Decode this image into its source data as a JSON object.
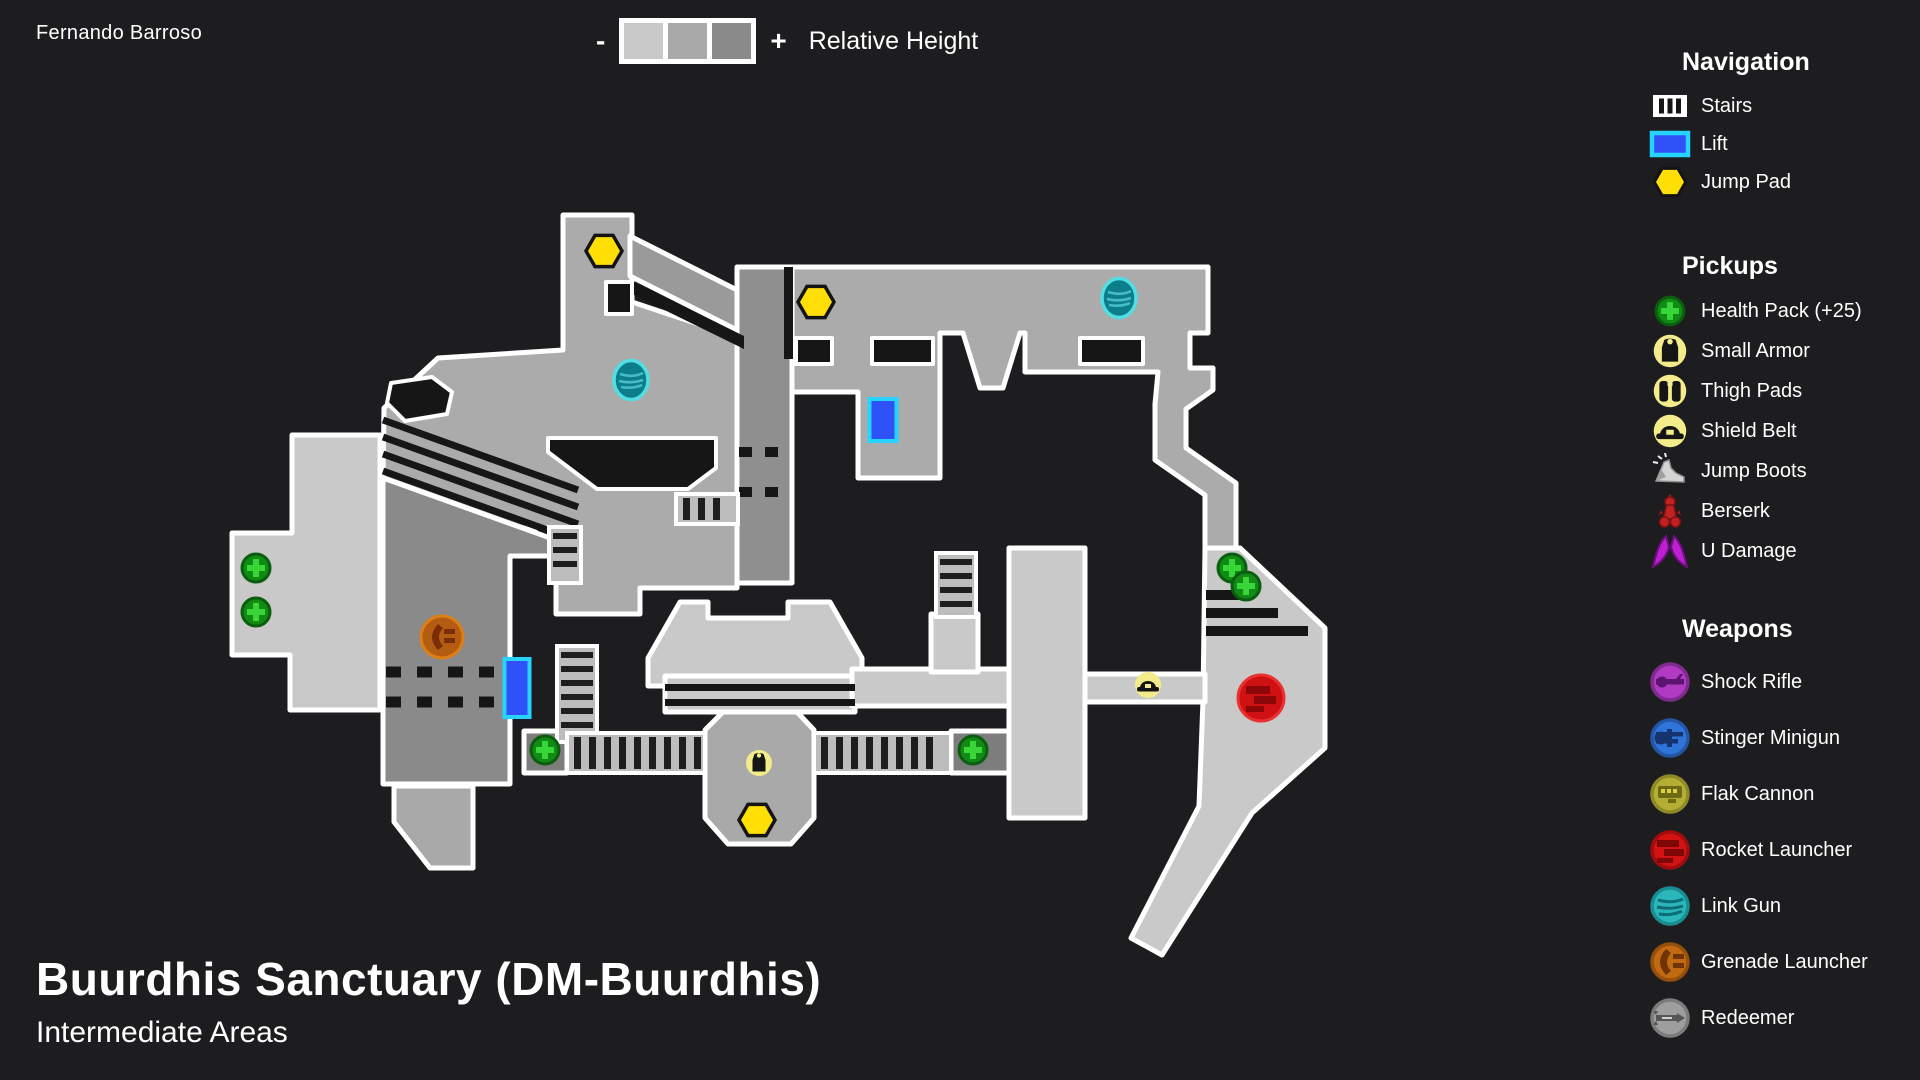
{
  "page": {
    "author": "Fernando Barroso",
    "title": "Buurdhis Sanctuary (DM-Buurdhis)",
    "subtitle": "Intermediate Areas"
  },
  "height_legend": {
    "minus": "-",
    "plus": "+",
    "label": "Relative Height",
    "swatches": [
      "#c9c9c9",
      "#a9a9a9",
      "#8a8a8a"
    ]
  },
  "sidebar": {
    "navigation": {
      "title": "Navigation",
      "items": [
        {
          "icon": "stairs",
          "label": "Stairs"
        },
        {
          "icon": "lift",
          "label": "Lift"
        },
        {
          "icon": "jump-pad",
          "label": "Jump Pad"
        }
      ]
    },
    "pickups": {
      "title": "Pickups",
      "items": [
        {
          "icon": "health-pack",
          "label": "Health Pack (+25)"
        },
        {
          "icon": "small-armor",
          "label": "Small Armor"
        },
        {
          "icon": "thigh-pads",
          "label": "Thigh Pads"
        },
        {
          "icon": "shield-belt",
          "label": "Shield Belt"
        },
        {
          "icon": "jump-boots",
          "label": "Jump Boots"
        },
        {
          "icon": "berserk",
          "label": "Berserk"
        },
        {
          "icon": "u-damage",
          "label": "U Damage"
        }
      ]
    },
    "weapons": {
      "title": "Weapons",
      "items": [
        {
          "icon": "shock-rifle",
          "label": "Shock Rifle",
          "fill": "#b13ac2",
          "ring": "#7e2b8d",
          "glyph": "#5b1570"
        },
        {
          "icon": "stinger-minigun",
          "label": "Stinger Minigun",
          "fill": "#2f74d8",
          "ring": "#2356a5",
          "glyph": "#16336e"
        },
        {
          "icon": "flak-cannon",
          "label": "Flak Cannon",
          "fill": "#b5ae35",
          "ring": "#8f8a26",
          "glyph": "#6e6a14"
        },
        {
          "icon": "rocket-launcher",
          "label": "Rocket Launcher",
          "fill": "#d31313",
          "ring": "#a30c0c",
          "glyph": "#7e0606"
        },
        {
          "icon": "link-gun",
          "label": "Link Gun",
          "fill": "#2ab6ba",
          "ring": "#188e92",
          "glyph": "#0c6e74"
        },
        {
          "icon": "grenade-launcher",
          "label": "Grenade Launcher",
          "fill": "#c26a12",
          "ring": "#96500c",
          "glyph": "#6e3404"
        },
        {
          "icon": "redeemer",
          "label": "Redeemer",
          "fill": "#9e9e9e",
          "ring": "#7c7c7c",
          "glyph": "#565656"
        }
      ]
    }
  },
  "map": {
    "colors": {
      "background": "#1d1d1f",
      "floor_low": "#c9c9c9",
      "floor_mid": "#ababab",
      "floor_high": "#8a8a8a",
      "outline": "#ffffff",
      "detail": "#161616",
      "jump_pad": "#ffdf06",
      "lift_fill": "#2e52f8",
      "lift_border": "#27d3ff",
      "health_fill": "#128a16",
      "health_cross": "#38d638",
      "badge_yellow": "#f4ec8b",
      "link_fill": "#0c7e8a",
      "link_ring": "#52dfe4",
      "grenade_fill": "#b45c11",
      "rocket_fill": "#cf1111"
    },
    "markers": [
      {
        "type": "jump-pad",
        "x": 604,
        "y": 251
      },
      {
        "type": "jump-pad",
        "x": 816,
        "y": 302
      },
      {
        "type": "jump-pad",
        "x": 757,
        "y": 820
      },
      {
        "type": "lift",
        "x": 883,
        "y": 420,
        "w": 27,
        "h": 42
      },
      {
        "type": "lift",
        "x": 517,
        "y": 688,
        "w": 25,
        "h": 58
      },
      {
        "type": "link-gun",
        "x": 631,
        "y": 380
      },
      {
        "type": "link-gun",
        "x": 1119,
        "y": 298
      },
      {
        "type": "health-pack",
        "x": 256,
        "y": 568
      },
      {
        "type": "health-pack",
        "x": 256,
        "y": 612
      },
      {
        "type": "health-pack",
        "x": 545,
        "y": 750
      },
      {
        "type": "health-pack",
        "x": 973,
        "y": 750
      },
      {
        "type": "health-pack",
        "x": 1232,
        "y": 568
      },
      {
        "type": "health-pack",
        "x": 1246,
        "y": 586
      },
      {
        "type": "grenade-launcher",
        "x": 442,
        "y": 637
      },
      {
        "type": "shield-belt",
        "x": 1148,
        "y": 685
      },
      {
        "type": "rocket-launcher",
        "x": 1261,
        "y": 698
      },
      {
        "type": "small-armor",
        "x": 759,
        "y": 763
      }
    ],
    "stairs": [
      {
        "x": 549,
        "y": 527,
        "w": 32,
        "h": 56,
        "dir": "h"
      },
      {
        "x": 676,
        "y": 494,
        "w": 62,
        "h": 30,
        "dir": "v"
      },
      {
        "x": 557,
        "y": 646,
        "w": 40,
        "h": 96,
        "dir": "h"
      },
      {
        "x": 936,
        "y": 553,
        "w": 40,
        "h": 64,
        "dir": "h"
      },
      {
        "x": 567,
        "y": 733,
        "w": 138,
        "h": 40,
        "dir": "v"
      },
      {
        "x": 814,
        "y": 733,
        "w": 137,
        "h": 40,
        "dir": "v"
      }
    ]
  }
}
